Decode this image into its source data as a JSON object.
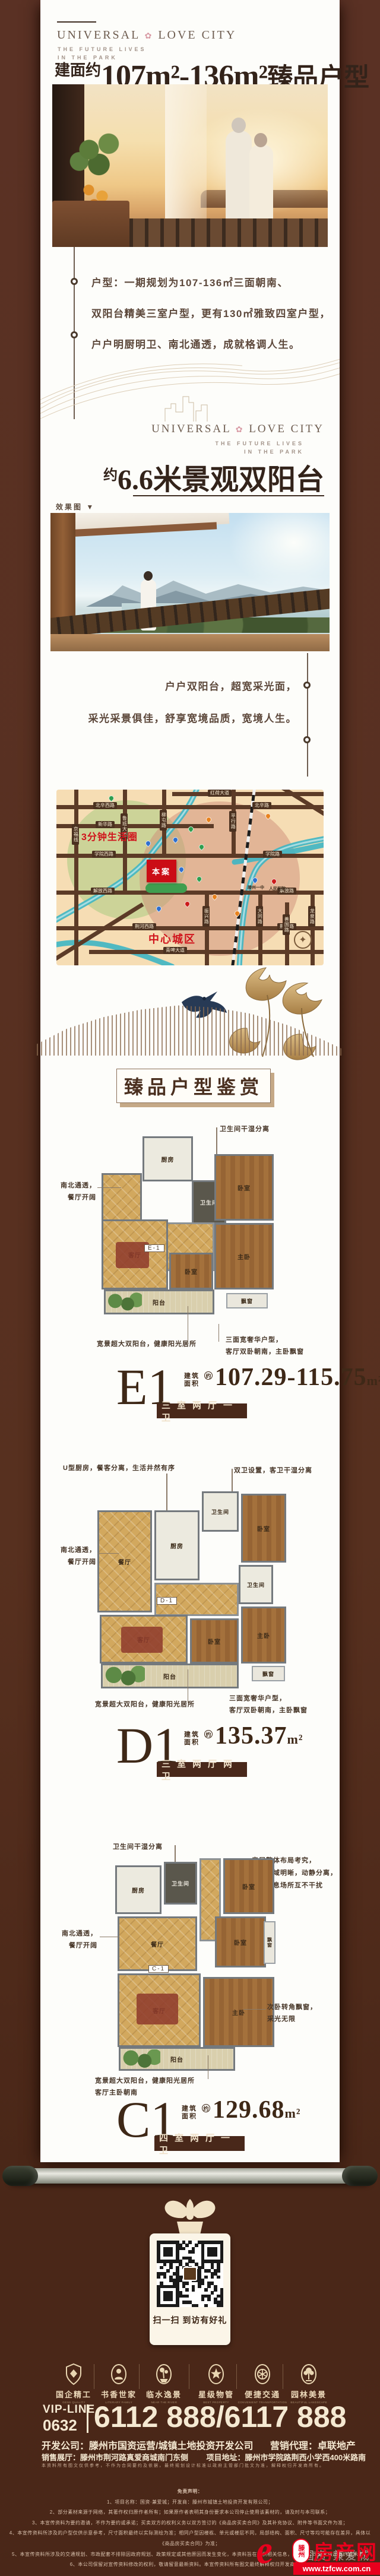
{
  "brand": {
    "name_left": "UNIVERSAL",
    "name_right": "LOVE CITY",
    "flower": "✿",
    "tagline1": "THE FUTURE LIVES",
    "tagline2": "IN THE PARK"
  },
  "colors": {
    "accent_red": "#cb0c15",
    "deep_brown": "#49281a",
    "cream": "#f3e7cd"
  },
  "s1": {
    "title_prefix": "建面约",
    "title_range": "107m²-136m²",
    "title_suffix": "臻品户型",
    "render_arrow": "▼",
    "render_tag": "效果图",
    "bullets": [
      "户型：一期规划为107-136㎡三面朝南、",
      "双阳台精美三室户型，更有130㎡雅致四室户型，",
      "户户明厨明卫、南北通透，成就格调人生。"
    ]
  },
  "s2": {
    "title_prefix": "约",
    "title_main": "6.6米景观双阳台",
    "render_tag": "效果图",
    "render_arrow": "▼",
    "bullets": [
      "户户双阳台，超宽采光面，",
      "采光采景俱佳，舒享宽境品质，宽境人生。"
    ]
  },
  "map": {
    "zone_label": "3分钟生活圈",
    "site_label": "本案",
    "center_label": "中心城区",
    "roads_h": [
      "红荷大道",
      "北辛西路",
      "北辛路",
      "新华路",
      "学院西路",
      "学院路",
      "解放西路",
      "解放路",
      "荆河西路",
      "荆河路",
      "青啤大道"
    ],
    "roads_v": [
      "京福线",
      "鲁班大道",
      "柳屯路",
      "平行路",
      "振兴路",
      "大同路",
      "善国路",
      "龙泉路"
    ],
    "pois": [
      "滕州一中",
      "人民医院"
    ]
  },
  "gallery_title": "臻品户型鉴赏",
  "plans": [
    {
      "name": "E1",
      "area_prefix_1": "建筑",
      "area_prefix_2": "面积",
      "approx": "约",
      "area": "107.29-115.75",
      "unit": "m²",
      "type": "三室两厅一卫",
      "tag": "E-1",
      "rooms": {
        "kitchen": "厨房",
        "bath": "卫生间",
        "dining": "餐厅",
        "living": "客厅",
        "bed": "卧室",
        "bed2": "卧室",
        "master": "主卧",
        "balcony": "阳台",
        "bay": "飘窗"
      },
      "ann_top": "卫生间干湿分离",
      "ann_left_1": "南北通透，",
      "ann_left_2": "餐厅开阔",
      "ann_bottom_left": "宽景超大双阳台，健康阳光居所",
      "ann_bottom_right_1": "三面宽奢华户型，",
      "ann_bottom_right_2": "客厅双卧朝南，主卧飘窗"
    },
    {
      "name": "D1",
      "area_prefix_1": "建筑",
      "area_prefix_2": "面积",
      "approx": "约",
      "area": "135.37",
      "unit": "m²",
      "type": "三室两厅两卫",
      "tag": "D-1",
      "rooms": {
        "kitchen": "厨房",
        "bath": "卫生间",
        "bath2": "卫生间",
        "dining": "餐厅",
        "living": "客厅",
        "bed": "卧室",
        "bed2": "卧室",
        "master": "主卧",
        "balcony": "阳台",
        "bay": "飘窗"
      },
      "ann_top_left": "U型厨房，餐客分离，生活井然有序",
      "ann_top_right": "双卫设置，客卫干湿分离",
      "ann_left_1": "南北通透，",
      "ann_left_2": "餐厅开阔",
      "ann_bottom_left": "宽景超大双阳台，健康阳光居所",
      "ann_bottom_right_1": "三面宽奢华户型，",
      "ann_bottom_right_2": "客厅双卧朝南，主卧飘窗"
    },
    {
      "name": "C1",
      "area_prefix_1": "建筑",
      "area_prefix_2": "面积",
      "approx": "约",
      "area": "129.68",
      "unit": "m²",
      "type": "四室两厅一卫",
      "tag": "C-1",
      "rooms": {
        "kitchen": "厨房",
        "bath": "卫生间",
        "dining": "餐厅",
        "living": "客厅",
        "bed": "卧室",
        "bed2": "卧室",
        "master": "主卧",
        "balcony": "阳台",
        "bay": "飘窗"
      },
      "ann_top_left": "卫生间干湿分离",
      "ann_top_right_1": "房屋整体布局考究，",
      "ann_top_right_2": "功能区域明晰，动静分离，",
      "ann_top_right_3": "活动休息场所互不干扰",
      "ann_left_1": "南北通透，",
      "ann_left_2": "餐厅开阔",
      "ann_right_1": "次卧转角飘窗，",
      "ann_right_2": "采光无限",
      "ann_bottom_left": "宽景超大双阳台，健康阳光居所",
      "ann_bottom_left2": "客厅主卧朝南"
    }
  ],
  "footer": {
    "qr_label": "扫一扫 到访有好礼",
    "features": [
      {
        "label": "国企精工",
        "en": "GENS QUALITY"
      },
      {
        "label": "书香世家",
        "en": "LITERARY FAMILY"
      },
      {
        "label": "临水逸景",
        "en": "NEAR THE RIVER"
      },
      {
        "label": "星级物管",
        "en": "BEST PROPERTY"
      },
      {
        "label": "便捷交通",
        "en": "CONVENIENT TRANSPORTATION"
      },
      {
        "label": "园林美景",
        "en": "BEAUTIFUL LANDSCAPE"
      }
    ],
    "vip_label": "VIP-LINE",
    "vip_area_code": "0632",
    "phones": "6112 888/6117 888",
    "dev_line": "开发公司：滕州市国资运营/城镇土地投资开发公司",
    "agent_line": "营销代理：卓联地产",
    "hall_line": "销售展厅：滕州市荆河路真爱商城南门东侧",
    "addr_line": "项目地址：滕州市学院路荆西小学西400米路南",
    "fine_print": "本资料所有图文仅供参考，不作为合同要约及依据，最终规划设计标准以政府主管部门批文为准，解释权归开发商所有。",
    "disclaimer_title": "免责声明：",
    "disclaimers": [
      "1、项目名称：国资·兼爱城；开发商：滕州市城镇土地投资开发有限公司；",
      "2、部分素材来源于网络，其著作权归原作者所有；如果原作者表明其身份要求本公司停止使用该素材的，请及时与本司联系；",
      "3、本宣传资料为要约邀请，不作为要约或承诺；买卖双方的权利义务以双方签订的《商品房买卖合同》及其补充协议、附件等书面文件为准；",
      "4、本宣传资料所涉及的户型仅供示意参考，尺寸面积最终以实际测绘为准；相同户型因楼栋、单元或楼层不同，局部结构、面积、尺寸等均可能存在差异，具体以《商品房买卖合同》为准；",
      "5、本宣传资料所涉及的交通规划、市政配套不排除因政府规划、政策规定或其他原因而发生变化，本资料旨在提供相关信息，不代表公司对此做出要约或承诺；",
      "6、本公司保留对宣传资料修改的权利，敬请留意最新资料。本宣传资料所有图文最终解释权归开发商所有。"
    ],
    "watermark": {
      "behind": "国资·兼爱城",
      "site": "滕州",
      "name": "房产网",
      "url": "www.tzfcw.com.cn"
    }
  }
}
